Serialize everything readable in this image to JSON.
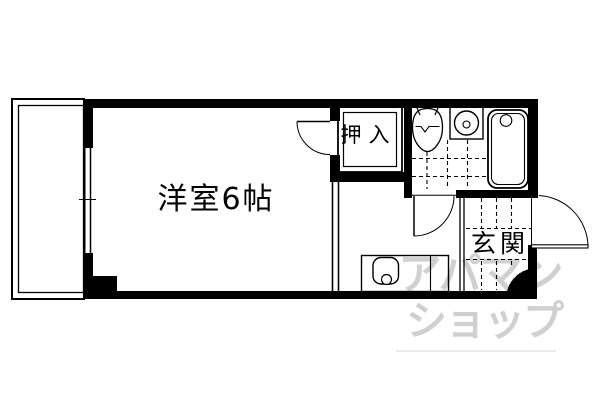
{
  "floorplan": {
    "labels": {
      "room": "洋室6帖",
      "closet": "押入",
      "entrance": "玄関"
    },
    "watermark": {
      "line1": "アパマン",
      "line2": "ショップ",
      "color": "#d0d0d0"
    },
    "colors": {
      "wall": "#000000",
      "line": "#000000",
      "background": "#ffffff"
    },
    "symbols": {
      "balcony": "balcony-double-outline",
      "window": "sliding-window",
      "doors": [
        "room-swing-door",
        "bathroom-swing-door",
        "entrance-swing-door"
      ],
      "fixtures": [
        "toilet",
        "washbasin",
        "bathtub",
        "kitchen-sink"
      ],
      "floor_marks": [
        "bath-tile-dashed-grid",
        "genkan-step-dashed-lines"
      ]
    }
  }
}
